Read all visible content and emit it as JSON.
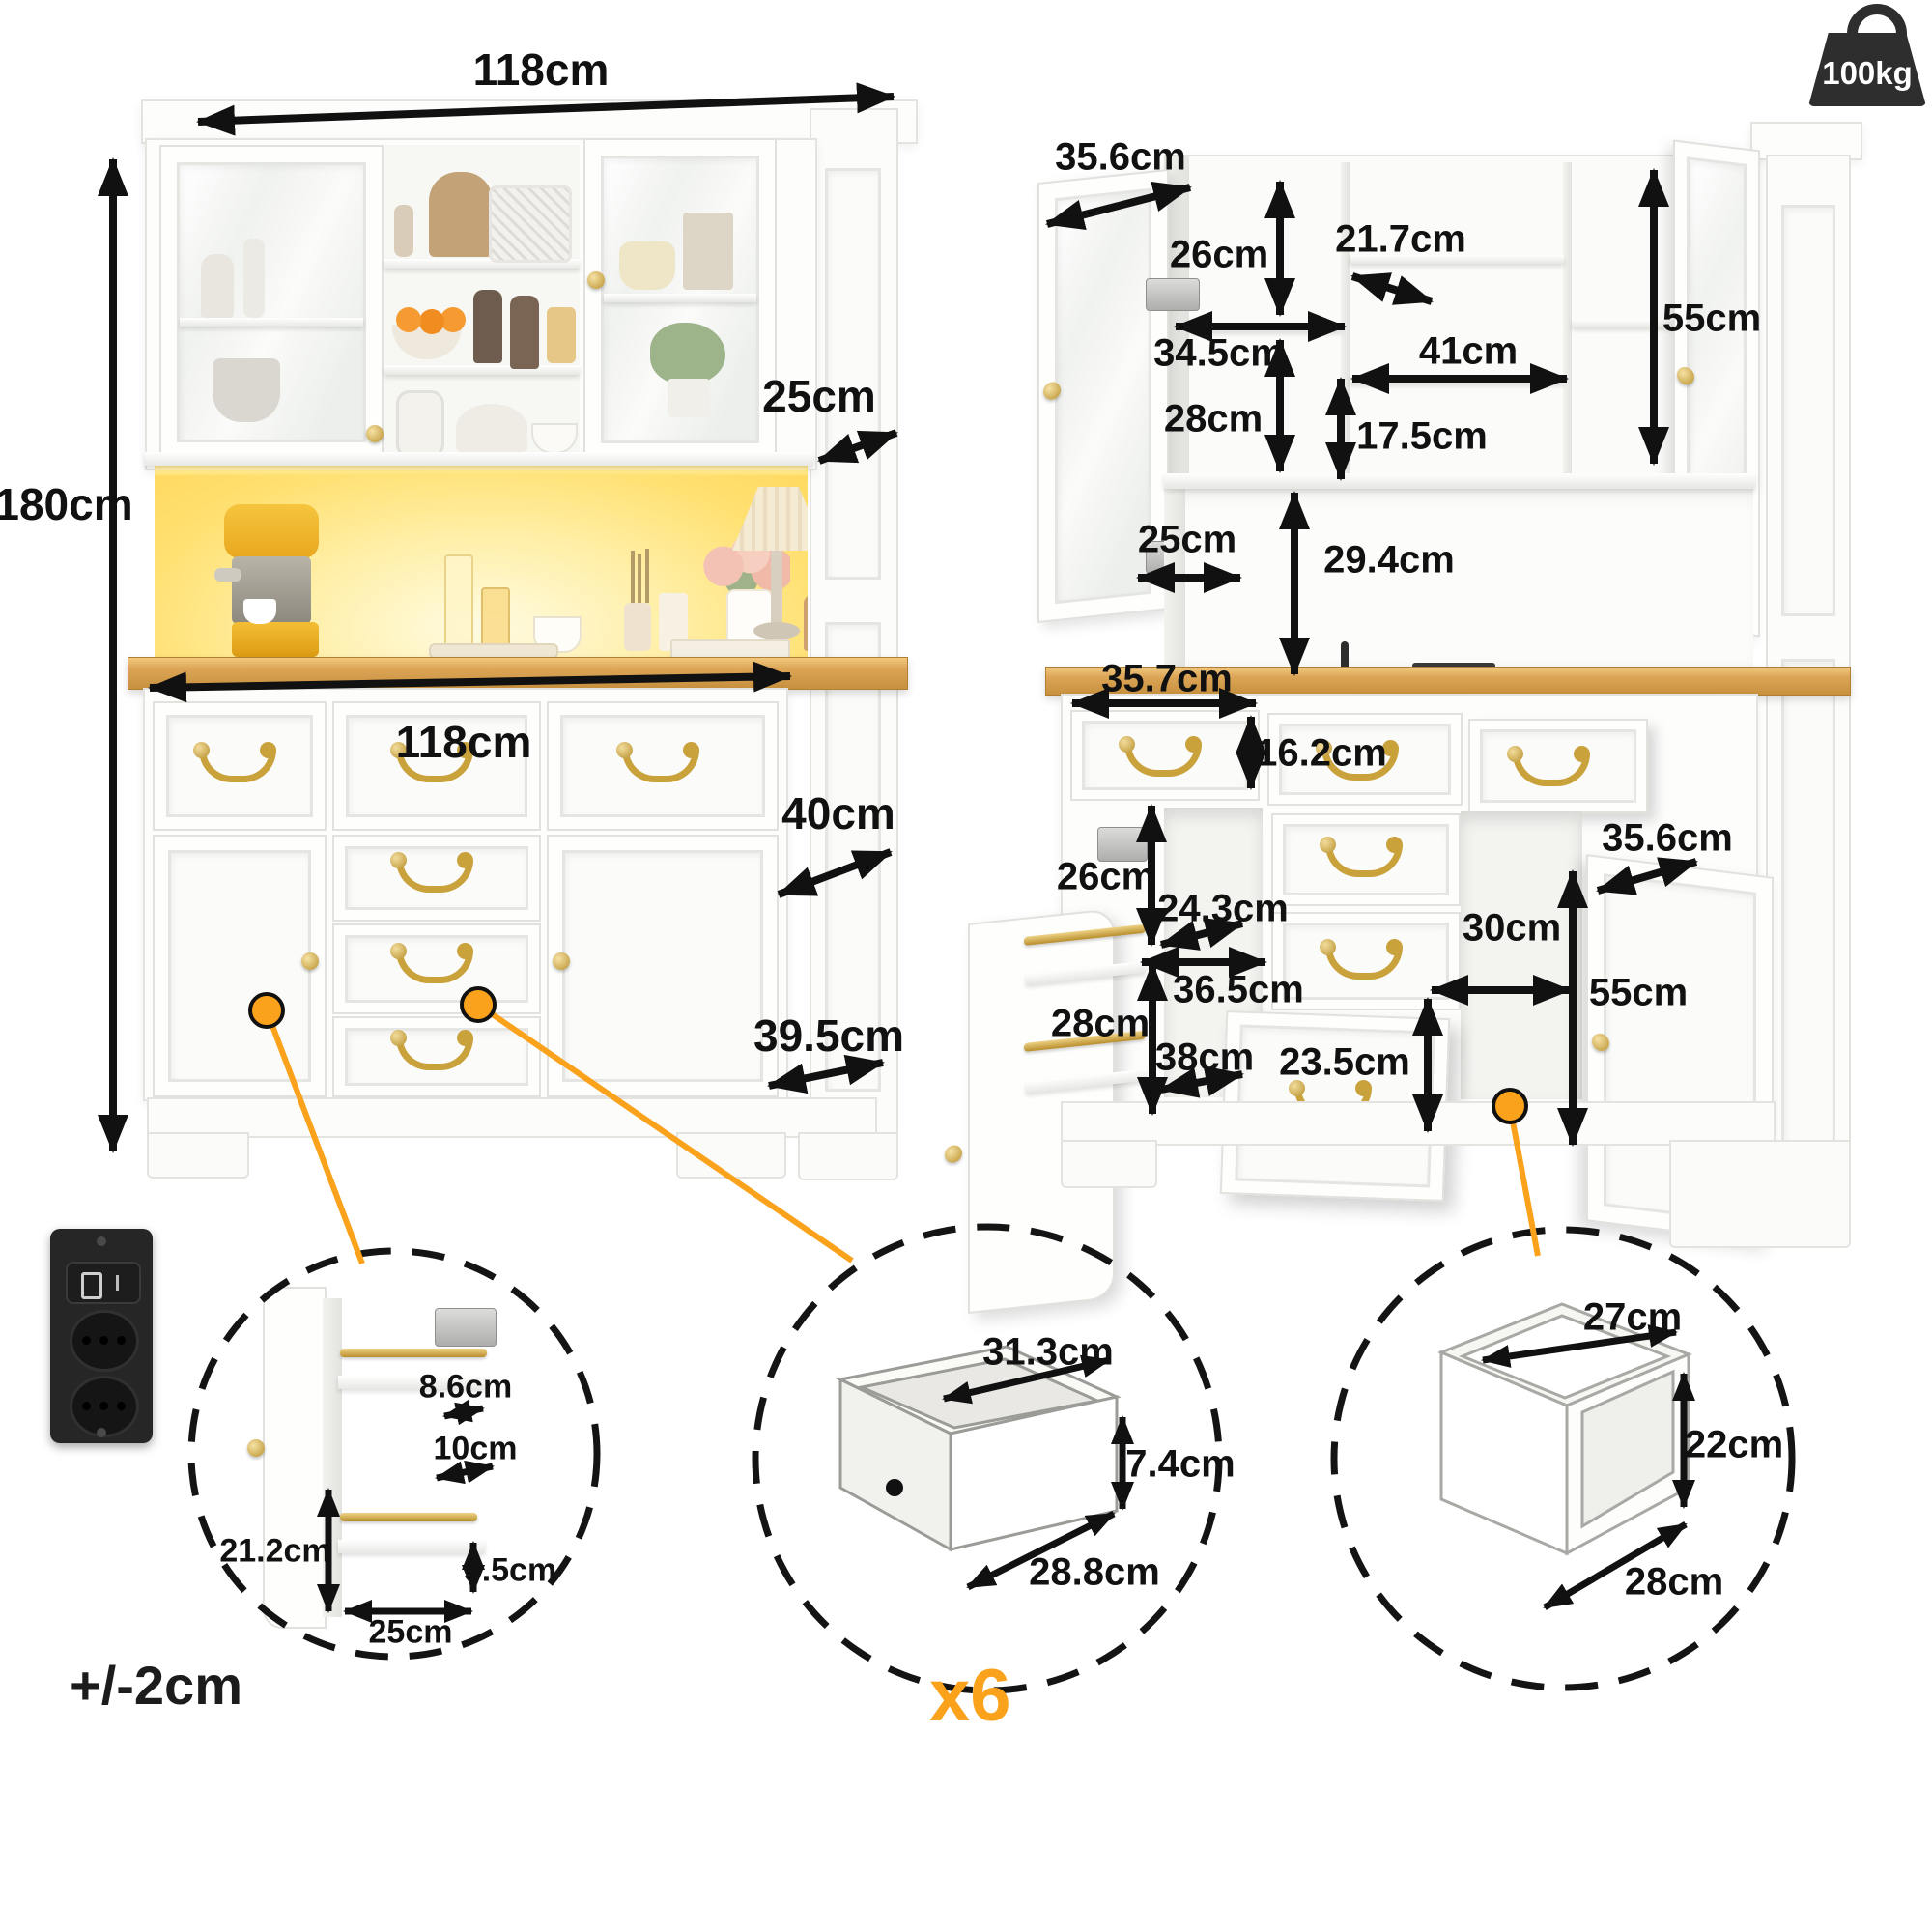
{
  "meta": {
    "tolerance": "+/-2cm",
    "multiplier": "x6",
    "weight_capacity": "100kg"
  },
  "left_view": {
    "width_top": "118cm",
    "height": "180cm",
    "hutch_depth": "25cm",
    "counter_width": "118cm",
    "counter_depth": "40cm",
    "base_depth": "39.5cm"
  },
  "right_view": {
    "hutch": {
      "door_width": "35.6cm",
      "left_upper_height": "26cm",
      "middle_top_width": "21.7cm",
      "left_shelf_width": "34.5cm",
      "middle_shelf_width": "41cm",
      "left_lower_height": "28cm",
      "middle_lower_height": "17.5cm",
      "inner_height": "55cm",
      "niche_depth": "25cm",
      "niche_height": "29.4cm"
    },
    "base": {
      "drawer_width": "35.7cm",
      "drawer_height": "16.2cm",
      "door_width": "35.6cm",
      "left_upper_height": "26cm",
      "left_shelf_width": "24.3cm",
      "open_width": "30cm",
      "middle_width": "36.5cm",
      "inner_height": "55cm",
      "left_lower_height": "28cm",
      "left_lower_width": "38cm",
      "bottom_drawer_height": "23.5cm"
    }
  },
  "details": {
    "door_rack": {
      "rail_width": "8.6cm",
      "shelf_depth": "10cm",
      "column_height": "21.2cm",
      "rail_height": "9.5cm",
      "shelf_width": "25cm"
    },
    "drawer_box": {
      "width": "31.3cm",
      "height": "7.4cm",
      "depth": "28.8cm"
    },
    "open_compartment": {
      "width": "27cm",
      "height": "22cm",
      "depth": "28cm"
    }
  },
  "colors": {
    "accent_orange": "#faa21b",
    "gold": "#c9a23c",
    "wood": "#dca557",
    "led_glow": "#ffe27a"
  }
}
